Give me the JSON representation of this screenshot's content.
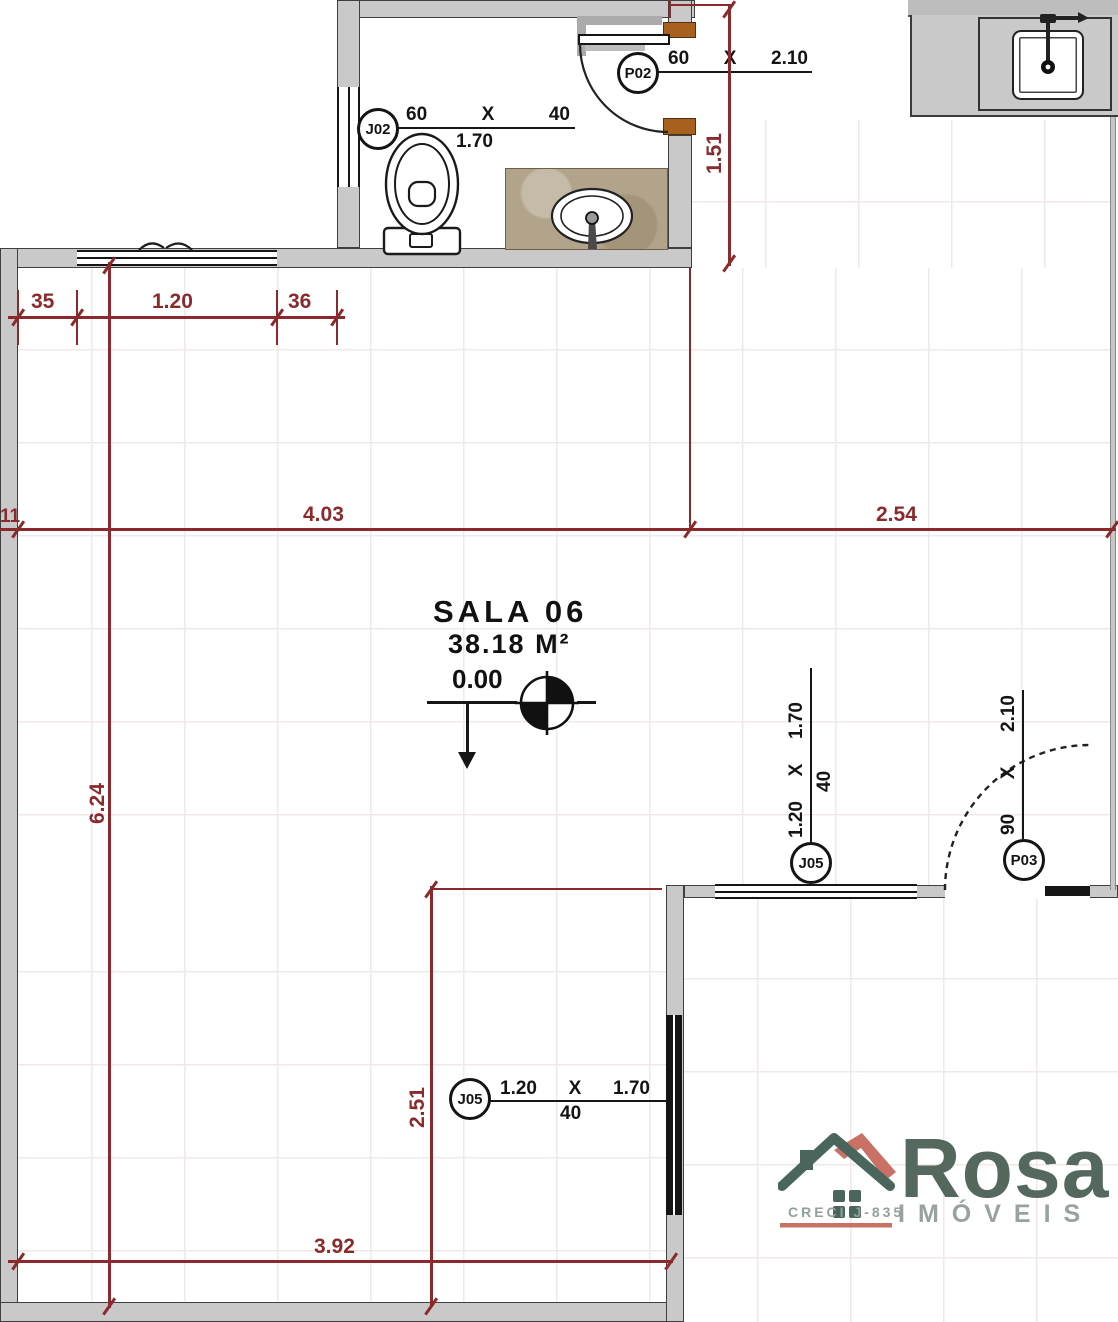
{
  "room": {
    "name": "SALA 06",
    "area": "38.18 M²",
    "level": "0.00"
  },
  "dims": {
    "top_chain": [
      "35",
      "1.20",
      "36"
    ],
    "width_main": "4.03",
    "width_right": "2.54",
    "height_left": "6.24",
    "bath_height": "1.51",
    "lower_height": "2.51",
    "bottom_width": "3.92",
    "edge_partial": "11"
  },
  "openings": {
    "j02": {
      "code": "J02",
      "w": "60",
      "sep": "X",
      "h": "40",
      "sill": "1.70"
    },
    "p02": {
      "code": "P02",
      "w": "60",
      "sep": "X",
      "h": "2.10"
    },
    "j05_top": {
      "code": "J05",
      "w": "1.20",
      "sep": "X",
      "h": "1.70",
      "sill": "40"
    },
    "p03": {
      "code": "P03",
      "w": "90",
      "sep": "X",
      "h": "2.10"
    },
    "j05_bottom": {
      "code": "J05",
      "w": "1.20",
      "sep": "X",
      "h": "1.70",
      "sill": "40"
    }
  },
  "logo": {
    "brand": "Rosa",
    "subtitle": "IMÓVEIS",
    "creci": "CRECI J-835"
  },
  "colors": {
    "dim_red": "#8a2a2d",
    "wall_gray": "#c9c9c9",
    "jamb_brown": "#a8601f",
    "vanity_tan": "#b2a48b",
    "logo_green": "#55685e",
    "logo_salmon": "#ca7165",
    "logo_gray": "#9aa1a1"
  }
}
